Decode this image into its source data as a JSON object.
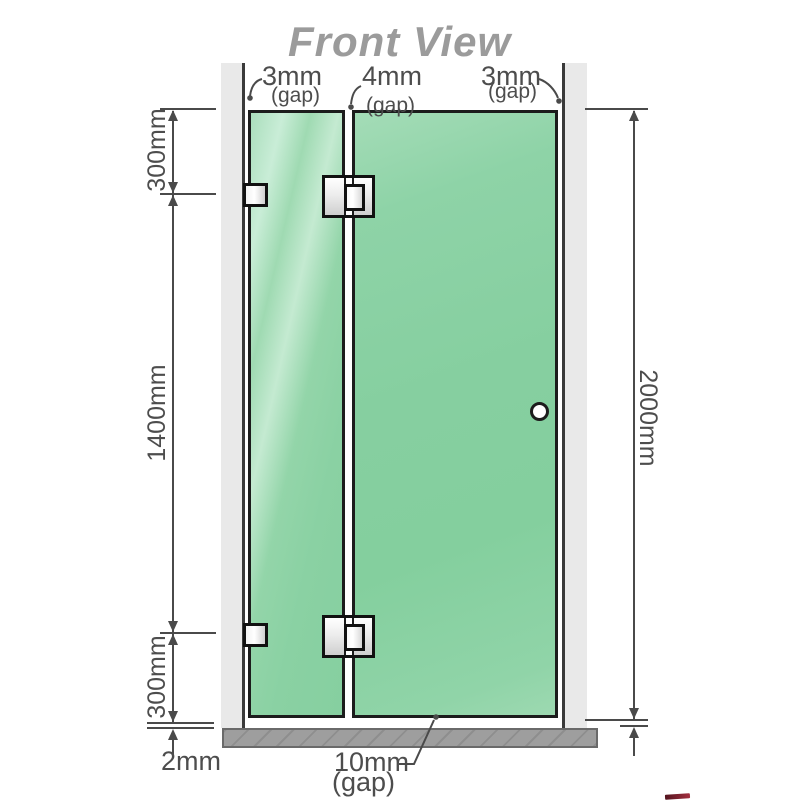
{
  "title": "Front View",
  "top_gap_labels": [
    {
      "value": "3mm",
      "note": "(gap)"
    },
    {
      "value": "4mm",
      "note": "(gap)"
    },
    {
      "value": "3mm",
      "note": "(gap)"
    }
  ],
  "left_dimensions": {
    "top_segment": "300mm",
    "middle_segment": "1400mm",
    "bottom_segment": "300mm",
    "floor_gap": "2mm"
  },
  "right_dimensions": {
    "overall_height": "2000mm"
  },
  "bottom_gap_label": {
    "value": "10mm",
    "note": "(gap)"
  },
  "hardware": {
    "wall_brackets": 2,
    "hinges": 2,
    "knob": "door-knob"
  },
  "colors": {
    "glass_green": "#87d0a2",
    "glass_highlight": "#c9edd7",
    "wall_gray": "#e9e9e9",
    "floor_gray": "#9e9e9e",
    "dimension_line": "#4a4a4a",
    "outline_black": "#1c1c1c",
    "title_gray": "#9b9b9b",
    "accent_red": "#8c2432"
  }
}
